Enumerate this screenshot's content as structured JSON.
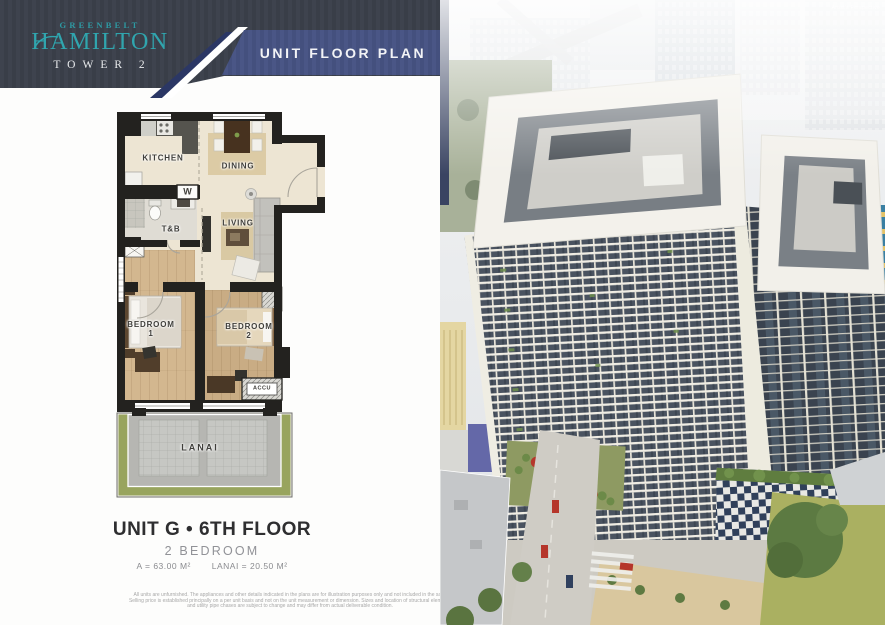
{
  "header": {
    "brand_top": "GREENBELT",
    "brand_main": "HAMILTON",
    "brand_sub": "TOWER 2",
    "banner": "UNIT FLOOR PLAN"
  },
  "plan": {
    "rooms": {
      "kitchen": "KITCHEN",
      "dining": "DINING",
      "living": "LIVING",
      "tnb": "T&B",
      "washer": "W",
      "bedroom1_line1": "BEDROOM",
      "bedroom1_line2": "1",
      "bedroom2_line1": "BEDROOM",
      "bedroom2_line2": "2",
      "accu": "ACCU",
      "lanai": "LANAI"
    }
  },
  "unit_info": {
    "title": "UNIT G • 6TH FLOOR",
    "type": "2 BEDROOM",
    "area_unit": "A = 63.00 M²",
    "area_lanai": "LANAI = 20.50 M²"
  },
  "disclaimer": {
    "line1": "All units are unfurnished. The appliances and other details indicated in the plans are for illustration purposes only and not included in the sale.",
    "line2": "Selling price is established principally on a per unit basis and not on the unit measurement or dimension. Sizes and location of structural elements",
    "line3": "and utility pipe chases are subject to change and may differ from actual deliverable condition."
  },
  "perspective_note": "Artist's Perspective",
  "colors": {
    "teal": "#2FA3AB",
    "charcoal": "#3A3E48",
    "banner_blue": "#46517F",
    "navy_accent": "#2B3765",
    "wall_black": "#23221F",
    "floor_beige": "#EDE5D3",
    "wood": "#D3B78F",
    "grass": "#97A35F"
  }
}
